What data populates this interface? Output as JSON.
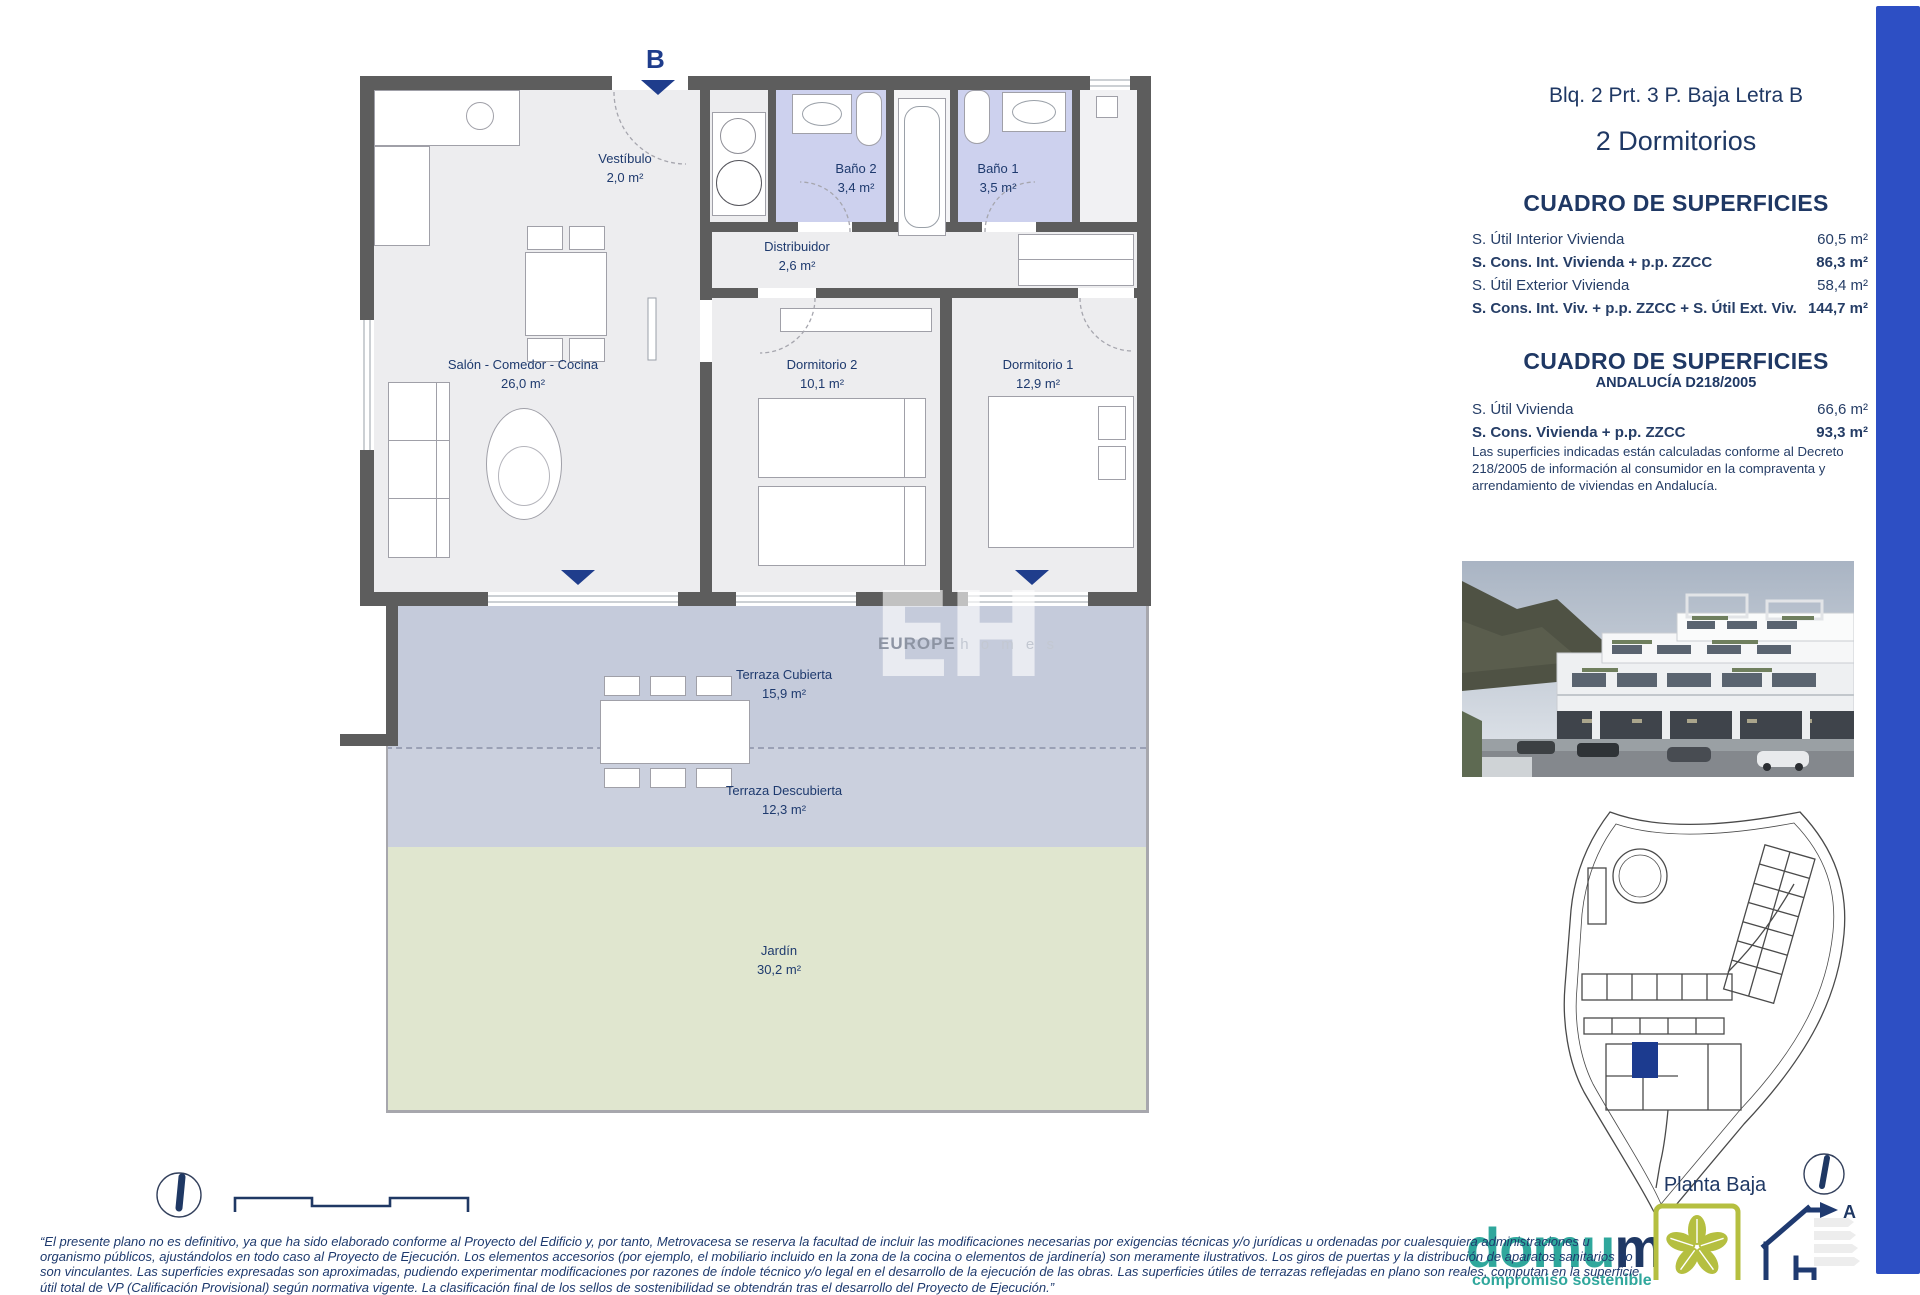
{
  "plan": {
    "entry_label": "B",
    "rooms": [
      {
        "name": "Vestíbulo",
        "area": "2,0 m²"
      },
      {
        "name": "Baño 2",
        "area": "3,4 m²"
      },
      {
        "name": "Baño 1",
        "area": "3,5 m²"
      },
      {
        "name": "Distribuidor",
        "area": "2,6 m²"
      },
      {
        "name": "Salón - Comedor - Cocina",
        "area": "26,0 m²"
      },
      {
        "name": "Dormitorio 2",
        "area": "10,1 m²"
      },
      {
        "name": "Dormitorio 1",
        "area": "12,9 m²"
      },
      {
        "name": "Terraza Cubierta",
        "area": "15,9 m²"
      },
      {
        "name": "Terraza Descubierta",
        "area": "12,3 m²"
      },
      {
        "name": "Jardín",
        "area": "30,2 m²"
      }
    ],
    "watermark": {
      "initials": "EH",
      "brand": "EUROPE",
      "brand2": "h o m e s"
    }
  },
  "panel": {
    "unit_title": "Blq. 2 Prt. 3 P. Baja Letra B",
    "unit_subtitle": "2 Dormitorios",
    "surfaces": {
      "title": "CUADRO DE SUPERFICIES",
      "rows": [
        {
          "label": "S. Útil Interior Vivienda",
          "value": "60,5 m²"
        },
        {
          "label": "S. Cons. Int. Vivienda + p.p. ZZCC",
          "value": "86,3 m²"
        },
        {
          "label": "S. Útil Exterior Vivienda",
          "value": "58,4 m²"
        },
        {
          "label": "S. Cons. Int. Viv. + p.p. ZZCC + S. Útil Ext. Viv.",
          "value": "144,7 m²"
        }
      ]
    },
    "surfaces_andalucia": {
      "title": "CUADRO DE SUPERFICIES",
      "subtitle": "ANDALUCÍA D218/2005",
      "rows": [
        {
          "label": "S. Útil Vivienda",
          "value": "66,6 m²"
        },
        {
          "label": "S. Cons. Vivienda + p.p. ZZCC",
          "value": "93,3 m²"
        }
      ],
      "note": "Las superficies indicadas están calculadas conforme al Decreto 218/2005 de información al consumidor en la compraventa y arrendamiento de viviendas en Andalucía."
    },
    "floor_label": "Planta Baja"
  },
  "logos": {
    "domum_main": "domu",
    "domum_last": "m",
    "domum_tagline": "compromiso sostenible",
    "verde": "VERDE",
    "energy_rating": "A"
  },
  "footer": {
    "disclaimer_lines": [
      "“El presente plano no es definitivo, ya que ha sido elaborado conforme al Proyecto del Edificio y, por tanto, Metrovacesa se reserva la facultad de incluir las modificaciones necesarias por exigencias técnicas y/o jurídicas u ordenadas por cualesquiera administraciones u",
      "organismo públicos, ajustándolos en todo caso al Proyecto de Ejecución. Los elementos accesorios (por ejemplo, el mobiliario incluido en la zona de la cocina o elementos de jardinería) son meramente ilustrativos. Los giros de puertas y la distribución de aparatos sanitarios no",
      "son vinculantes. Las superficies expresadas son aproximadas, pudiendo experimentar modificaciones por razones de índole técnico y/o legal en el desarrollo de la ejecución de las obras. Las superficies útiles de terrazas reflejadas en plano son reales, computan en la superficie",
      "útil total de VP (Calificación Provisional) según normativa vigente. La clasificación final de los sellos de sostenibilidad se obtendrán tras el desarrollo del Proyecto de Ejecución.”"
    ]
  },
  "colors": {
    "accent_navy": "#1F3864",
    "royal_blue": "#2D4FC4",
    "bath_lavender": "#CDD1EE",
    "terrace_blue": "#C5CBDB",
    "garden_green": "#E0E6CF",
    "wall_gray": "#5D5D5D"
  }
}
